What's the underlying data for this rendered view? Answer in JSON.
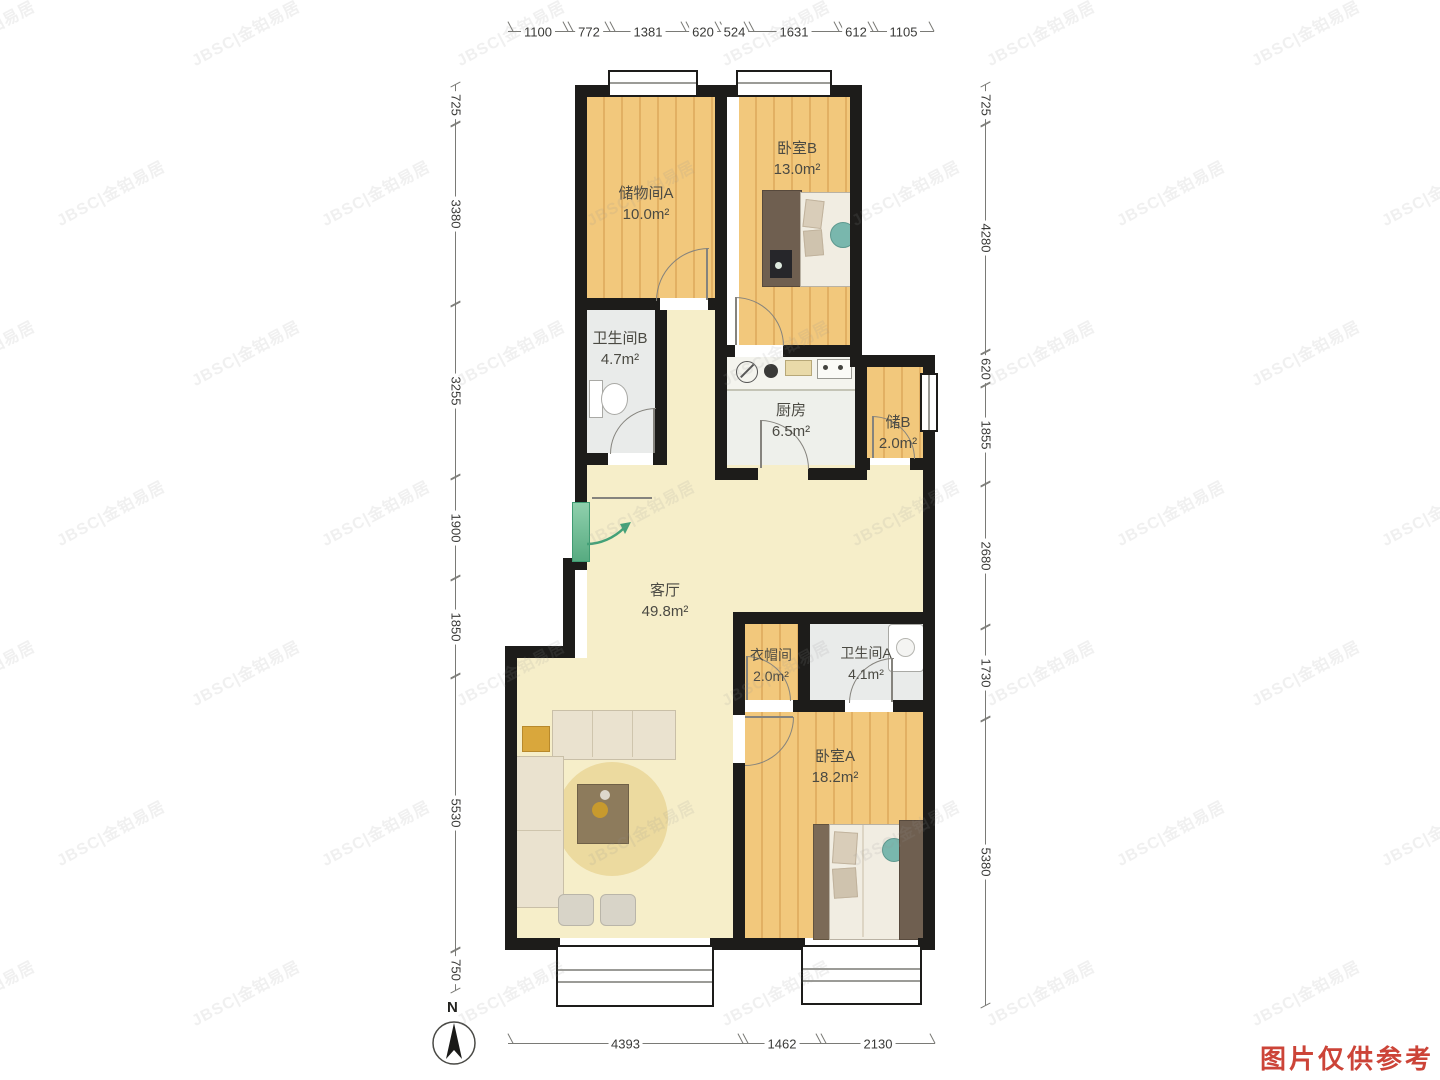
{
  "page": {
    "north_label": "N",
    "disclaimer": "图片仅供参考",
    "watermark": "JBSC|金铂易居"
  },
  "rooms": [
    {
      "name": "储物间A",
      "area": "10.0m²"
    },
    {
      "name": "卧室B",
      "area": "13.0m²"
    },
    {
      "name": "卫生间B",
      "area": "4.7m²"
    },
    {
      "name": "厨房",
      "area": "6.5m²"
    },
    {
      "name": "储B",
      "area": "2.0m²"
    },
    {
      "name": "客厅",
      "area": "49.8m²"
    },
    {
      "name": "衣帽间",
      "area": "2.0m²"
    },
    {
      "name": "卫生间A",
      "area": "4.1m²"
    },
    {
      "name": "卧室A",
      "area": "18.2m²"
    }
  ],
  "dimensions_mm": {
    "top": [
      "1100",
      "772",
      "1381",
      "620",
      "524",
      "1631",
      "612",
      "1105"
    ],
    "left": [
      "725",
      "3380",
      "3255",
      "1900",
      "1850",
      "5530",
      "750"
    ],
    "right": [
      "725",
      "4280",
      "620",
      "1855",
      "2680",
      "1730",
      "5380"
    ],
    "bottom": [
      "4393",
      "1462",
      "2130"
    ]
  },
  "colors": {
    "wall": "#1d1c1a",
    "wood_floor": "#f2c87c",
    "living_floor": "#f6eec9",
    "bath_floor": "#e9ebea",
    "entry_door_green": "#7ecba4",
    "disclaimer_red": "#cc4438",
    "dimension_text": "#3a3a38"
  }
}
